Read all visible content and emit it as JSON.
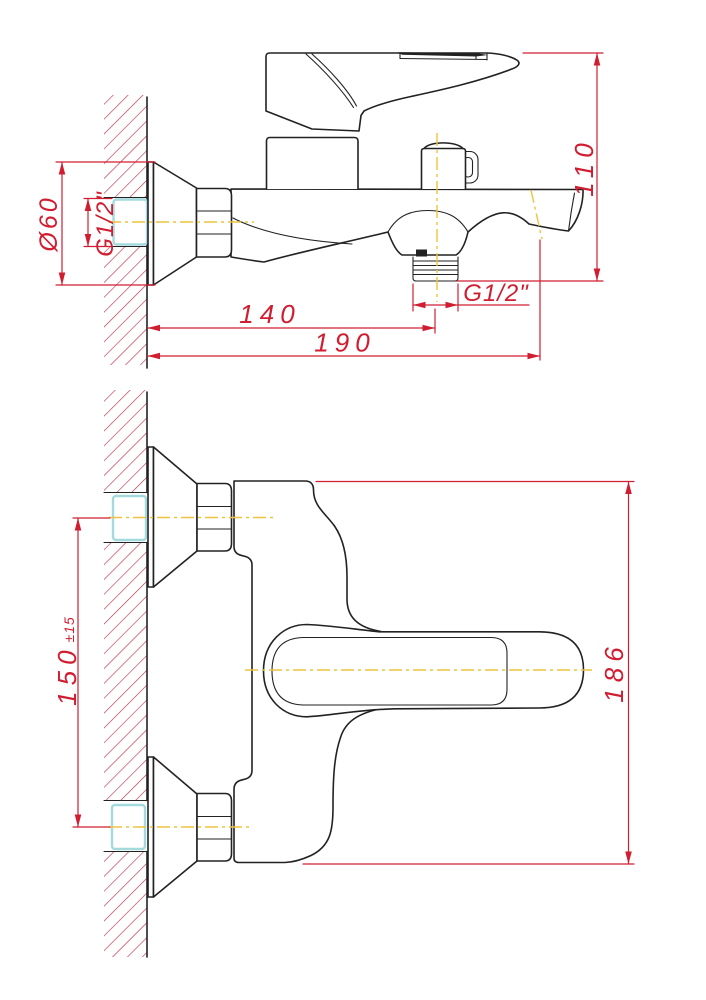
{
  "colors": {
    "outline": "#222222",
    "dimension_red": "#d01d30",
    "hatch_red": "#c22741",
    "centerline_yellow": "#eec43e",
    "pipe_cyan": "#a3dade",
    "background": "#ffffff"
  },
  "views": {
    "side": {
      "dims": {
        "escutcheon_diameter": "Ø60",
        "inlet_thread": "G1/2\"",
        "height": "110",
        "outlet_offset": "140",
        "total_reach": "190",
        "outlet_thread": "G1/2\""
      }
    },
    "front": {
      "dims": {
        "inlet_spacing": "150",
        "inlet_spacing_tolerance": "±15",
        "overall_width": "186"
      }
    }
  }
}
